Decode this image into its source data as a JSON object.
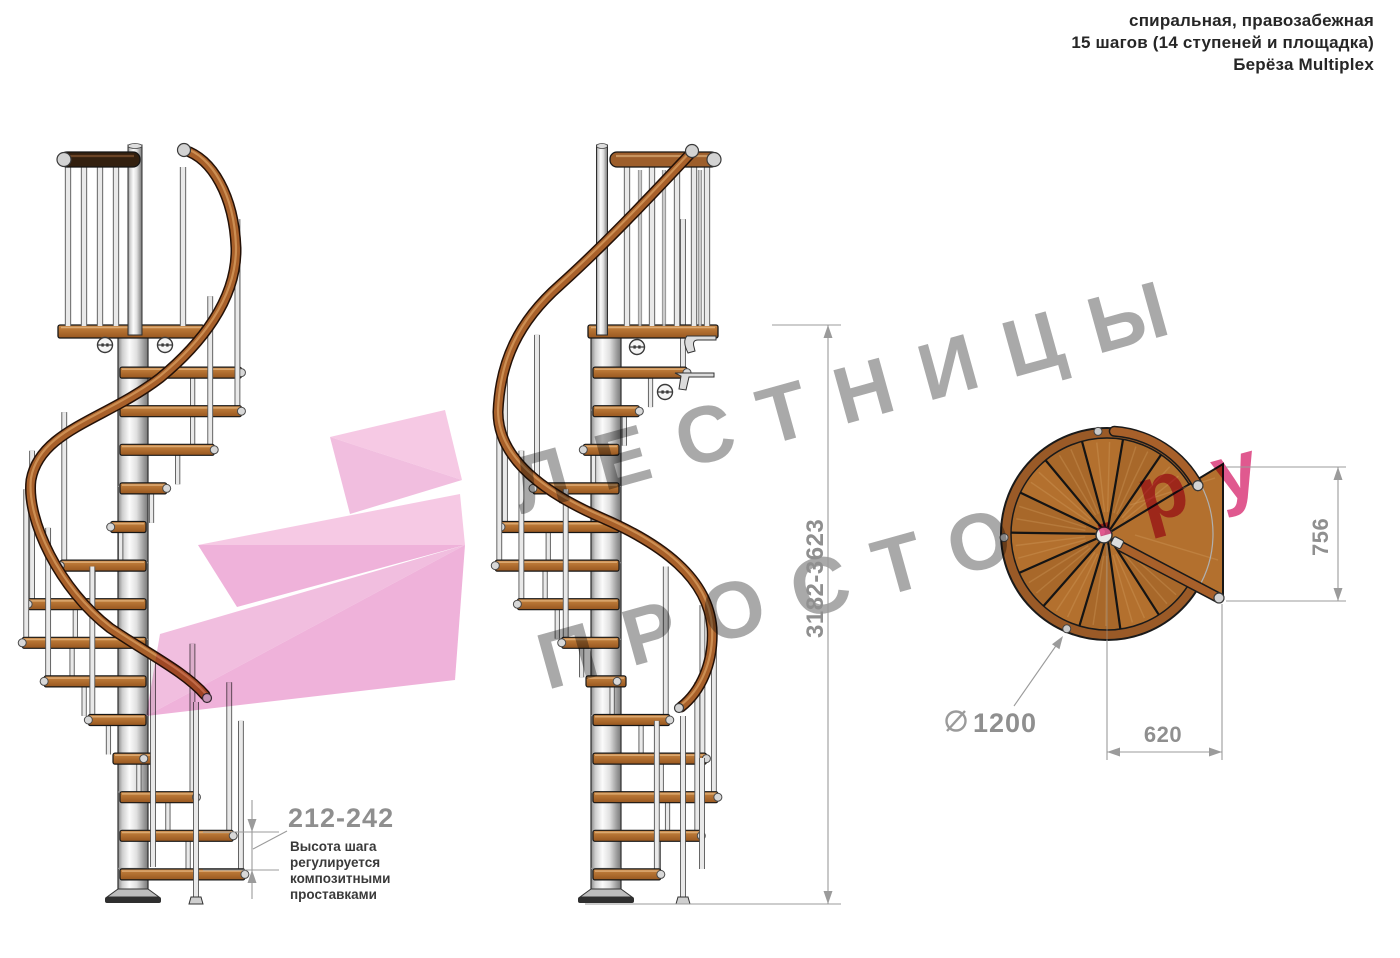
{
  "header": {
    "line1": "спиральная, правозабежная",
    "line2": "15 шагов (14 ступеней и площадка)",
    "line3": "Берёза Multiplex"
  },
  "watermark": {
    "line1": "ЛЕСТНИЦЫ",
    "line2": "ПРОСТО",
    "suffix": ".ру",
    "text_color": "#9e9e9e",
    "accent_color": "#dc4380",
    "arrow_pink_light": "#f5c3e1",
    "arrow_pink_mid": "#f0b7db",
    "arrow_pink_dark": "#edaad6"
  },
  "dimensions": {
    "total_height": "3182-3623",
    "landing_length": "756",
    "landing_width": "620",
    "diameter": "1200",
    "step_height": "212-242",
    "note_lines": [
      "Высота шага",
      "регулируется",
      "композитными",
      "проставками"
    ]
  },
  "drawing": {
    "colors": {
      "wood_light": "#cf9152",
      "wood_mid": "#b4722f",
      "wood_dark": "#98571f",
      "rail_fill": "#a8602a",
      "rail_outline": "#241107",
      "rail_highlight": "#cf9356",
      "dark_rail": "#33200f",
      "steel_cap": "#d3d3d3",
      "rod_edge": "#555555",
      "rod_fill": "#e9e9e9",
      "outline": "#2e2e2e",
      "plan_rim": "#9a5a27",
      "plan_wood_a": "#b3702e",
      "plan_wood_b": "#a8682a",
      "dim_line": "#9b9b9b"
    }
  }
}
